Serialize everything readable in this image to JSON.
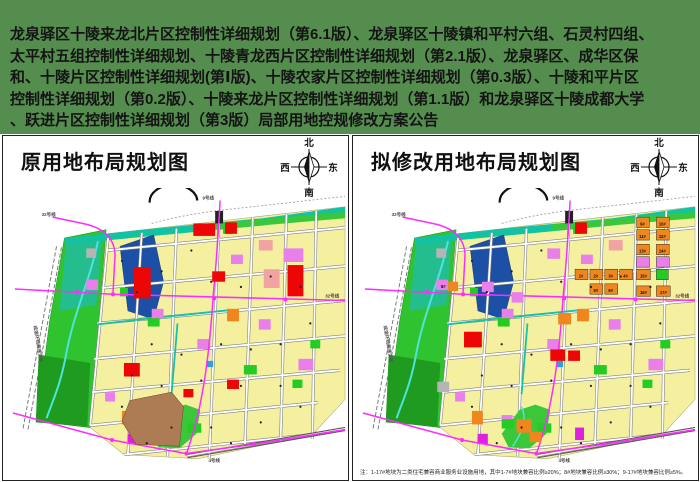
{
  "banner": {
    "bg": "#548D4E",
    "lines": [
      "龙泉驿区十陵来龙北片区控制性详细规划（第6.1版）、龙泉驿区十陵镇和平村六组、石灵村四组、",
      "太平村五组控制性详细规划、十陵青龙西片区控制性详细规划（第2.1版）、龙泉驿区、成华区保",
      "和、十陵片区控制性详细规划(第Ⅰ版)、十陵农家片区控制性详细规划（第0.3版）、十陵和平片区",
      "控制性详细规划（第0.2版）、十陵来龙片区控制性详细规划（第1.1版）和龙泉驿区十陵成都大学",
      "、跃进片区控制性详细规划（第3版）局部用地控规修改方案公告"
    ]
  },
  "panels": {
    "left": {
      "title": "原用地布局规划图"
    },
    "right": {
      "title": "拟修改用地布局规划图",
      "note": "注：1-17#地块为二类住宅兼容商业服务业设施用地，其中1-7#地块兼容比例≥20%；8#地块兼容比例≥30%；9-17#地块兼容比例≥5%。"
    }
  },
  "compass": {
    "north": "北",
    "south": "南",
    "west": "西",
    "east": "东"
  },
  "colors": {
    "residential_yellow": "#F4F0A0",
    "park_green": "#2FC42F",
    "dark_green": "#1F9C1F",
    "teal_greenway": "#12C2A2",
    "water_blue": "#1C4FA6",
    "river_cyan": "#4FE3E0",
    "commercial_red": "#EE0505",
    "mixed_orange": "#F0861E",
    "public_violet": "#E97FE9",
    "salmon_pink": "#F2A2A2",
    "logistics_brown": "#AD7C55",
    "metro_magenta": "#FF2BFF",
    "road_casing": "#828282",
    "dot": "#222222"
  },
  "maps": {
    "base": [
      {
        "t": "l",
        "d": "M54,56 L20,232 M59,57 L25,233",
        "s": "#7a7a7a",
        "w": 1,
        "dash": "4,2"
      },
      {
        "t": "l",
        "d": "M150,34 C180,26 210,22 252,18 L345,8",
        "s": "#999999",
        "w": 0.8,
        "dash": "2,2"
      },
      {
        "t": "p",
        "pts": "62,48 104,40 97,126 88,230 34,224 47,128",
        "f": "#2FC42F",
        "s": "#139313",
        "w": 0.5
      },
      {
        "t": "p",
        "pts": "64,50 100,44 94,112 57,118",
        "f": "#24BE8E"
      },
      {
        "t": "p",
        "pts": "36,160 88,168 85,229 33,225",
        "f": "#1F9C1F"
      },
      {
        "t": "l",
        "d": "M96,50 C88,88 72,118 64,158 C58,190 50,204 44,221",
        "s": "#4FE3E0",
        "w": 2
      },
      {
        "t": "p",
        "pts": "104,44 345,18 345,203 312,237 196,260 122,256 88,230 97,126",
        "f": "#F4F0A0",
        "s": "#A5A26B",
        "w": 0.5
      },
      {
        "t": "p",
        "pts": "62,48 162,38 262,29 345,18 345,24 262,36 163,45 63,54",
        "f": "#12C2A2"
      },
      {
        "t": "p",
        "pts": "200,35 345,23 345,29 200,41",
        "f": "#3AC83A"
      },
      {
        "t": "p",
        "pts": "118,56 152,45 162,90 152,126 126,118",
        "f": "#1C4FA6",
        "s": "#10306E",
        "w": 0.4
      },
      {
        "t": "l",
        "d": "M104,60 L345,38 M100,96 L345,75 M95,130 L345,108 M92,164 L345,142 M90,196 L340,175 M88,228 L318,206 M122,256 L310,237 M106,48 L88,228 M140,43 L126,255 M175,39 L166,258 M218,31 L208,260 M252,28 L244,247 M286,25 L280,244 M316,22 L312,241 M185,257 L345,231",
        "s": "#828282",
        "w": 3
      },
      {
        "t": "l",
        "d": "M104,60 L345,38 M100,96 L345,75 M95,130 L345,108 M92,164 L345,142 M90,196 L340,175 M88,228 L318,206 M122,256 L310,237 M106,48 L88,228 M140,43 L126,255 M175,39 L166,258 M218,31 L208,260 M252,28 L244,247 M286,25 L280,244 M316,22 L312,241 M185,257 L345,231",
        "s": "#FFFFFF",
        "w": 1.8
      },
      {
        "t": "l",
        "d": "M140,126 L232,117 M176,130 L170,198 M95,131 L140,126",
        "s": "#14C4A4",
        "w": 1.8
      },
      {
        "t": "p",
        "pts": "150,236 168,213 184,208 199,213 195,236 178,250 157,249",
        "f": "#3AC83A"
      },
      {
        "t": "l",
        "d": "M170,210 C176,222 170,236 161,248",
        "s": "#4FE3E0",
        "w": 1.5
      },
      {
        "t": "r",
        "x": 222,
        "y": 36,
        "w": 9,
        "h": 8,
        "f": "#22CC22"
      },
      {
        "t": "r",
        "x": 146,
        "y": 124,
        "w": 12,
        "h": 9,
        "f": "#22CC22"
      },
      {
        "t": "r",
        "x": 243,
        "y": 170,
        "w": 13,
        "h": 9,
        "f": "#22CC22"
      },
      {
        "t": "r",
        "x": 310,
        "y": 146,
        "w": 10,
        "h": 8,
        "f": "#22CC22"
      },
      {
        "t": "r",
        "x": 186,
        "y": 226,
        "w": 14,
        "h": 9,
        "f": "#22CC22"
      },
      {
        "t": "r",
        "x": 292,
        "y": 184,
        "w": 10,
        "h": 8,
        "f": "#22CC22"
      },
      {
        "t": "r",
        "x": 118,
        "y": 96,
        "w": 8,
        "h": 8,
        "f": "#22CC22"
      },
      {
        "t": "r",
        "x": 84,
        "y": 88,
        "w": 12,
        "h": 10,
        "f": "#E97FE9"
      },
      {
        "t": "r",
        "x": 150,
        "y": 116,
        "w": 12,
        "h": 9,
        "f": "#E97FE9"
      },
      {
        "t": "r",
        "x": 196,
        "y": 145,
        "w": 13,
        "h": 10,
        "f": "#E97FE9"
      },
      {
        "t": "r",
        "x": 230,
        "y": 64,
        "w": 12,
        "h": 9,
        "f": "#E97FE9"
      },
      {
        "t": "r",
        "x": 298,
        "y": 164,
        "w": 15,
        "h": 11,
        "f": "#E97FE9"
      },
      {
        "t": "r",
        "x": 150,
        "y": 218,
        "w": 11,
        "h": 9,
        "f": "#E97FE9"
      },
      {
        "t": "r",
        "x": 103,
        "y": 196,
        "w": 10,
        "h": 9,
        "f": "#E97FE9"
      },
      {
        "t": "r",
        "x": 258,
        "y": 126,
        "w": 12,
        "h": 10,
        "f": "#E97FE9"
      },
      {
        "t": "r",
        "x": 126,
        "y": 236,
        "w": 10,
        "h": 10,
        "f": "#E020E0"
      },
      {
        "t": "r",
        "x": 258,
        "y": 50,
        "w": 14,
        "h": 10,
        "f": "#F2A2A2"
      },
      {
        "t": "r",
        "x": 226,
        "y": 116,
        "w": 12,
        "h": 12,
        "f": "#F0861E"
      },
      {
        "t": "r",
        "x": 120,
        "y": 214,
        "w": 11,
        "h": 13,
        "f": "#F0861E"
      },
      {
        "t": "r",
        "x": 84,
        "y": 58,
        "w": 10,
        "h": 9,
        "f": "#B5B5B5"
      },
      {
        "t": "r",
        "x": 205,
        "y": 166,
        "w": 7,
        "h": 6,
        "f": "#2E9FD8"
      },
      {
        "t": "r",
        "x": 224,
        "y": 33,
        "w": 12,
        "h": 11,
        "f": "#EE0505"
      },
      {
        "t": "l",
        "d": "M148,14 A24,16 0 0 1 196,12",
        "s": "#111111",
        "w": 2.2
      },
      {
        "t": "l",
        "d": "M185,256 L345,230 M186,259 L345,233",
        "s": "#555555",
        "w": 1
      },
      {
        "t": "r",
        "x": 214,
        "y": 22,
        "w": 8,
        "h": 12,
        "f": "#222222"
      },
      {
        "t": "l",
        "d": "M50,28 L80,34 Q112,40 113,64 L111,100",
        "s": "#FF2BFF",
        "w": 1.5
      },
      {
        "t": "l",
        "d": "M12,97 L111,102 L345,108",
        "s": "#FF2BFF",
        "w": 1.5
      },
      {
        "t": "l",
        "d": "M219,12 C217,48 214,84 212,104 C209,146 205,183 196,220 C191,238 187,250 185,255",
        "s": "#FF2BFF",
        "w": 1.5
      },
      {
        "t": "l",
        "d": "M10,216 L110,242 L185,255 L253,246 L345,232",
        "s": "#FF2BFF",
        "w": 1.5
      },
      {
        "t": "c",
        "cx": 75,
        "cy": 100,
        "r": 2,
        "f": "#FF2BFF"
      },
      {
        "t": "c",
        "cx": 111,
        "cy": 102,
        "r": 2,
        "f": "#FF2BFF"
      },
      {
        "t": "c",
        "cx": 213,
        "cy": 106,
        "r": 2,
        "f": "#FF2BFF"
      },
      {
        "t": "c",
        "cx": 285,
        "cy": 107,
        "r": 2,
        "f": "#FF2BFF"
      },
      {
        "t": "c",
        "cx": 110,
        "cy": 242,
        "r": 2,
        "f": "#FF2BFF"
      },
      {
        "t": "c",
        "cx": 185,
        "cy": 255,
        "r": 2,
        "f": "#FF2BFF"
      },
      {
        "t": "c",
        "cx": 253,
        "cy": 246,
        "r": 2,
        "f": "#FF2BFF"
      }
    ],
    "dots": [
      [
        120,
        70
      ],
      [
        135,
        100
      ],
      [
        160,
        80
      ],
      [
        190,
        60
      ],
      [
        210,
        90
      ],
      [
        240,
        95
      ],
      [
        270,
        85
      ],
      [
        300,
        95
      ],
      [
        150,
        150
      ],
      [
        180,
        160
      ],
      [
        220,
        150
      ],
      [
        250,
        155
      ],
      [
        280,
        150
      ],
      [
        310,
        130
      ],
      [
        130,
        180
      ],
      [
        160,
        190
      ],
      [
        200,
        185
      ],
      [
        240,
        190
      ],
      [
        280,
        190
      ],
      [
        120,
        210
      ],
      [
        170,
        230
      ],
      [
        210,
        230
      ],
      [
        260,
        225
      ],
      [
        300,
        210
      ],
      [
        145,
        245
      ],
      [
        230,
        245
      ]
    ],
    "left_only": [
      {
        "t": "r",
        "x": 132,
        "y": 76,
        "w": 17,
        "h": 30,
        "f": "#EE0505"
      },
      {
        "t": "r",
        "x": 287,
        "y": 74,
        "w": 16,
        "h": 30,
        "f": "#EE0505"
      },
      {
        "t": "r",
        "x": 192,
        "y": 34,
        "w": 22,
        "h": 12,
        "f": "#EE0505"
      },
      {
        "t": "r",
        "x": 211,
        "y": 80,
        "w": 13,
        "h": 10,
        "f": "#EE0505"
      },
      {
        "t": "r",
        "x": 122,
        "y": 168,
        "w": 16,
        "h": 13,
        "f": "#EE0505"
      },
      {
        "t": "r",
        "x": 226,
        "y": 184,
        "w": 12,
        "h": 9,
        "f": "#EE0505"
      },
      {
        "t": "r",
        "x": 182,
        "y": 193,
        "w": 10,
        "h": 8,
        "f": "#EE0505"
      },
      {
        "t": "r",
        "x": 263,
        "y": 78,
        "w": 16,
        "h": 18,
        "f": "#F2A2A2"
      },
      {
        "t": "r",
        "x": 283,
        "y": 58,
        "w": 20,
        "h": 13,
        "f": "#E97FE9"
      },
      {
        "t": "p",
        "pts": "128,204 170,196 182,210 178,248 134,246 120,224",
        "f": "#AD7C55",
        "s": "#6B4A2D",
        "w": 0.5
      }
    ],
    "right_only": [
      {
        "t": "r",
        "x": 286,
        "y": 28,
        "w": 13,
        "h": 10,
        "f": "#F0861E",
        "s": "#333",
        "w2": 0.5
      },
      {
        "t": "r",
        "x": 306,
        "y": 28,
        "w": 13,
        "h": 10,
        "f": "#F0861E",
        "s": "#333",
        "w2": 0.5
      },
      {
        "t": "r",
        "x": 286,
        "y": 40,
        "w": 13,
        "h": 10,
        "f": "#F0861E",
        "s": "#333",
        "w2": 0.5
      },
      {
        "t": "r",
        "x": 306,
        "y": 40,
        "w": 13,
        "h": 10,
        "f": "#F0861E",
        "s": "#333",
        "w2": 0.5
      },
      {
        "t": "r",
        "x": 286,
        "y": 54,
        "w": 13,
        "h": 10,
        "f": "#F0861E",
        "s": "#333",
        "w2": 0.5
      },
      {
        "t": "r",
        "x": 306,
        "y": 54,
        "w": 13,
        "h": 10,
        "f": "#F0861E",
        "s": "#333",
        "w2": 0.5
      },
      {
        "t": "r",
        "x": 286,
        "y": 66,
        "w": 13,
        "h": 10,
        "f": "#E97FE9",
        "s": "#333",
        "w2": 0.5
      },
      {
        "t": "r",
        "x": 306,
        "y": 66,
        "w": 13,
        "h": 10,
        "f": "#E97FE9",
        "s": "#333",
        "w2": 0.5
      },
      {
        "t": "r",
        "x": 224,
        "y": 78,
        "w": 13,
        "h": 10,
        "f": "#F0861E",
        "s": "#333",
        "w2": 0.5
      },
      {
        "t": "r",
        "x": 239,
        "y": 78,
        "w": 13,
        "h": 10,
        "f": "#F0861E",
        "s": "#333",
        "w2": 0.5
      },
      {
        "t": "r",
        "x": 254,
        "y": 78,
        "w": 13,
        "h": 10,
        "f": "#F0861E",
        "s": "#333",
        "w2": 0.5
      },
      {
        "t": "r",
        "x": 269,
        "y": 78,
        "w": 13,
        "h": 10,
        "f": "#F0861E",
        "s": "#333",
        "w2": 0.5
      },
      {
        "t": "r",
        "x": 286,
        "y": 78,
        "w": 14,
        "h": 10,
        "f": "#F0861E",
        "s": "#333",
        "w2": 0.5
      },
      {
        "t": "r",
        "x": 306,
        "y": 78,
        "w": 12,
        "h": 10,
        "f": "#22CC22",
        "s": "#333",
        "w2": 0.5
      },
      {
        "t": "r",
        "x": 239,
        "y": 92,
        "w": 13,
        "h": 10,
        "f": "#F0861E",
        "s": "#333",
        "w2": 0.5
      },
      {
        "t": "r",
        "x": 254,
        "y": 92,
        "w": 13,
        "h": 10,
        "f": "#F0861E",
        "s": "#333",
        "w2": 0.5
      },
      {
        "t": "r",
        "x": 286,
        "y": 94,
        "w": 14,
        "h": 10,
        "f": "#F0861E",
        "s": "#333",
        "w2": 0.5
      },
      {
        "t": "r",
        "x": 306,
        "y": 94,
        "w": 14,
        "h": 10,
        "f": "#F0861E",
        "s": "#333",
        "w2": 0.5
      },
      {
        "t": "r",
        "x": 96,
        "y": 90,
        "w": 10,
        "h": 9,
        "f": "#F0861E"
      },
      {
        "t": "r",
        "x": 207,
        "y": 120,
        "w": 13,
        "h": 11,
        "f": "#F0861E"
      },
      {
        "t": "r",
        "x": 165,
        "y": 222,
        "w": 15,
        "h": 13,
        "f": "#F0861E"
      },
      {
        "t": "r",
        "x": 178,
        "y": 234,
        "w": 12,
        "h": 10,
        "f": "#F0861E"
      },
      {
        "t": "r",
        "x": 112,
        "y": 138,
        "w": 18,
        "h": 15,
        "f": "#EE0505"
      },
      {
        "t": "r",
        "x": 199,
        "y": 155,
        "w": 15,
        "h": 11,
        "f": "#EE0505"
      },
      {
        "t": "r",
        "x": 217,
        "y": 156,
        "w": 12,
        "h": 10,
        "f": "#EE0505"
      },
      {
        "t": "r",
        "x": 130,
        "y": 90,
        "w": 12,
        "h": 10,
        "f": "#E97FE9"
      },
      {
        "t": "r",
        "x": 196,
        "y": 58,
        "w": 13,
        "h": 10,
        "f": "#E97FE9"
      },
      {
        "t": "r",
        "x": 160,
        "y": 100,
        "w": 12,
        "h": 10,
        "f": "#E97FE9"
      },
      {
        "t": "r",
        "x": 85,
        "y": 186,
        "w": 12,
        "h": 10,
        "f": "#B5B5B5"
      },
      {
        "t": "r",
        "x": 224,
        "y": 230,
        "w": 9,
        "h": 12,
        "f": "#E020E0"
      },
      {
        "t": "r",
        "x": 150,
        "y": 222,
        "w": 12,
        "h": 9,
        "f": "#22CC22"
      }
    ],
    "labels_base": [
      {
        "x": 46,
        "y": 27,
        "size": 4.5,
        "text": "32号线",
        "c": "#444"
      },
      {
        "x": 207,
        "y": 11,
        "size": 4.5,
        "text": "9号线",
        "c": "#444"
      },
      {
        "x": 332,
        "y": 105,
        "size": 4.5,
        "text": "32号线",
        "c": "#444"
      },
      {
        "x": 213,
        "y": 263,
        "size": 4.5,
        "text": "4号线",
        "c": "#444"
      },
      {
        "x": 34,
        "y": 150,
        "size": 4.5,
        "text": "成渝环线高速公路",
        "c": "#555",
        "rot": 80
      }
    ],
    "labels_left": [],
    "labels_right": [
      {
        "x": 292,
        "y": 36,
        "size": 4.2,
        "text": "9#",
        "c": "#111"
      },
      {
        "x": 312,
        "y": 36,
        "size": 4.2,
        "text": "10#",
        "c": "#111"
      },
      {
        "x": 292,
        "y": 48,
        "size": 4.2,
        "text": "11#",
        "c": "#111"
      },
      {
        "x": 312,
        "y": 48,
        "size": 4.2,
        "text": "12#",
        "c": "#111"
      },
      {
        "x": 292,
        "y": 62,
        "size": 4.2,
        "text": "13#",
        "c": "#111"
      },
      {
        "x": 312,
        "y": 62,
        "size": 4.2,
        "text": "14#",
        "c": "#111"
      },
      {
        "x": 230,
        "y": 86,
        "size": 4.2,
        "text": "1#",
        "c": "#111"
      },
      {
        "x": 245,
        "y": 86,
        "size": 4.2,
        "text": "2#",
        "c": "#111"
      },
      {
        "x": 260,
        "y": 86,
        "size": 4.2,
        "text": "3#",
        "c": "#111"
      },
      {
        "x": 275,
        "y": 86,
        "size": 4.2,
        "text": "4#",
        "c": "#111"
      },
      {
        "x": 293,
        "y": 86,
        "size": 4.2,
        "text": "15#",
        "c": "#111"
      },
      {
        "x": 245,
        "y": 100,
        "size": 4.2,
        "text": "5#",
        "c": "#111"
      },
      {
        "x": 260,
        "y": 100,
        "size": 4.2,
        "text": "6#",
        "c": "#111"
      },
      {
        "x": 293,
        "y": 102,
        "size": 4.2,
        "text": "16#",
        "c": "#111"
      },
      {
        "x": 313,
        "y": 102,
        "size": 4.2,
        "text": "17#",
        "c": "#111"
      },
      {
        "x": 91,
        "y": 96,
        "size": 4.2,
        "text": "8#",
        "c": "#111"
      }
    ]
  }
}
